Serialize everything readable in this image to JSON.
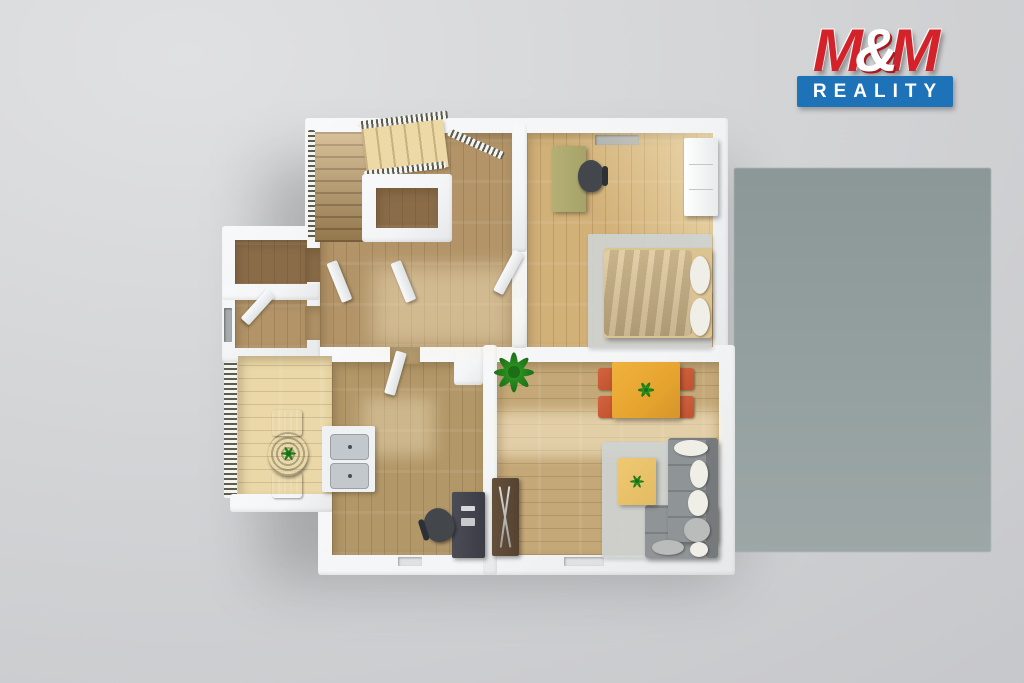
{
  "logo": {
    "m1": "M",
    "amp": "&",
    "m2": "M",
    "tagline": "REALITY"
  },
  "palette": {
    "bgLight": "#e0e1e2",
    "bgMid": "#d3d4d6",
    "bgDark": "#c5c6c9",
    "terraceTop": "#8c9898",
    "terraceBottom": "#9ca7a6",
    "wall": "#f4f5f6",
    "wallEdge": "#e6e8e9",
    "floorHall": "#b29468",
    "floorBedroom": "#d2b178",
    "floorDark": "#8a6c49",
    "floorKitchen": "#b29768",
    "floorLiving": "#c4a877",
    "deck": "#ead8a8",
    "stairLight": "#ecd9a6",
    "stairMid": "#c7a76f",
    "rug": "#cfd3d2",
    "sofa": "#8f9496",
    "sofaDark": "#767a7c",
    "pillow": "#f0efe7",
    "duvet": "#9a7b71",
    "bedFrame": "#dcc392",
    "deskOlive": "#b4b075",
    "deskDark": "#4c4c56",
    "tableOrange": "#e6a42e",
    "chairRed": "#c1512f",
    "coffeeTable": "#e3bb61",
    "cabinet": "#564230",
    "counter": "#eff1f2",
    "sink": "#c3c8cc",
    "plantGreen": "#2f9d24",
    "plantDark": "#1d6e16",
    "brandRed": "#d3222a",
    "brandBlue": "#1e72b8",
    "railDark": "#5c5c50",
    "doorWhite": "#f8f9fa"
  },
  "scene": {
    "type": "top-down 3d floor plan render on gray backdrop with shaded terrace area at right",
    "rooms": [
      {
        "name": "hall-staircase",
        "objects": [
          "staircase-two-flights",
          "stair-railings",
          "stairwell-void",
          "interior-doors"
        ]
      },
      {
        "name": "bedroom",
        "objects": [
          "double-bed-brown-duvet",
          "white-pillows",
          "gray-area-rug",
          "olive-desk",
          "office-chair",
          "white-wardrobe",
          "window"
        ]
      },
      {
        "name": "wc-small-room",
        "objects": [
          "dark-wood-floor"
        ]
      },
      {
        "name": "bathroom-small-room",
        "objects": [
          "open-door",
          "window"
        ]
      },
      {
        "name": "kitchen-study",
        "objects": [
          "double-sink-counter",
          "dark-desk",
          "office-chair",
          "open-door"
        ]
      },
      {
        "name": "living-room",
        "objects": [
          "orange-dining-table",
          "four-red-chairs",
          "gray-corner-sofa",
          "white-cushions",
          "coffee-table",
          "tv-cabinet",
          "potted-plant",
          "gray-area-rug"
        ]
      },
      {
        "name": "balcony",
        "objects": [
          "slatted-railing",
          "wood-decking",
          "round-bistro-table",
          "two-patio-chairs",
          "small-plant"
        ]
      }
    ]
  }
}
